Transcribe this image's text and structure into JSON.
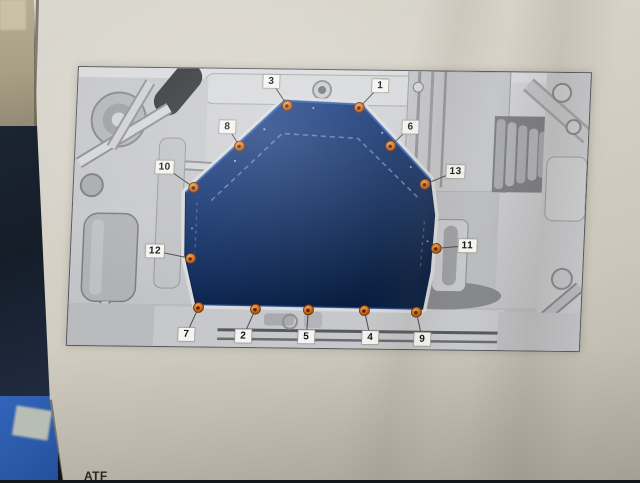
{
  "page": {
    "footer_fragment": "ATF"
  },
  "photo": {
    "colors": {
      "paper": "#d5d1c7",
      "wall_strip": "#a79e84",
      "dark_background_object": "#161e2a",
      "blue_background_object": "#2b59a8"
    }
  },
  "diagram": {
    "subject": "vehicle underbody with transmission oil pan highlighted",
    "pan_color": "#0d2a5e",
    "bolt_color": "#cf6d1e",
    "callout_count": 13,
    "callouts": [
      {
        "label": "1",
        "box": {
          "x": 302,
          "y": 15
        },
        "bolt": {
          "x": 282,
          "y": 37
        }
      },
      {
        "label": "2",
        "box": {
          "x": 176,
          "y": 267
        },
        "bolt": {
          "x": 187,
          "y": 240
        }
      },
      {
        "label": "3",
        "box": {
          "x": 193,
          "y": 12
        },
        "bolt": {
          "x": 210,
          "y": 36
        }
      },
      {
        "label": "4",
        "box": {
          "x": 303,
          "y": 267
        },
        "bolt": {
          "x": 296,
          "y": 240
        }
      },
      {
        "label": "5",
        "box": {
          "x": 239,
          "y": 267
        },
        "bolt": {
          "x": 240,
          "y": 240
        }
      },
      {
        "label": "6",
        "box": {
          "x": 334,
          "y": 56
        },
        "bolt": {
          "x": 315,
          "y": 75
        }
      },
      {
        "label": "7",
        "box": {
          "x": 119,
          "y": 266
        },
        "bolt": {
          "x": 130,
          "y": 239
        }
      },
      {
        "label": "8",
        "box": {
          "x": 151,
          "y": 58
        },
        "bolt": {
          "x": 164,
          "y": 77
        }
      },
      {
        "label": "9",
        "box": {
          "x": 355,
          "y": 268
        },
        "bolt": {
          "x": 348,
          "y": 241
        }
      },
      {
        "label": "10",
        "box": {
          "x": 90,
          "y": 99
        },
        "bolt": {
          "x": 120,
          "y": 119
        }
      },
      {
        "label": "11",
        "box": {
          "x": 396,
          "y": 174
        },
        "bolt": {
          "x": 365,
          "y": 177
        }
      },
      {
        "label": "12",
        "box": {
          "x": 84,
          "y": 183
        },
        "bolt": {
          "x": 120,
          "y": 190
        }
      },
      {
        "label": "13",
        "box": {
          "x": 381,
          "y": 100
        },
        "bolt": {
          "x": 351,
          "y": 113
        }
      }
    ]
  }
}
